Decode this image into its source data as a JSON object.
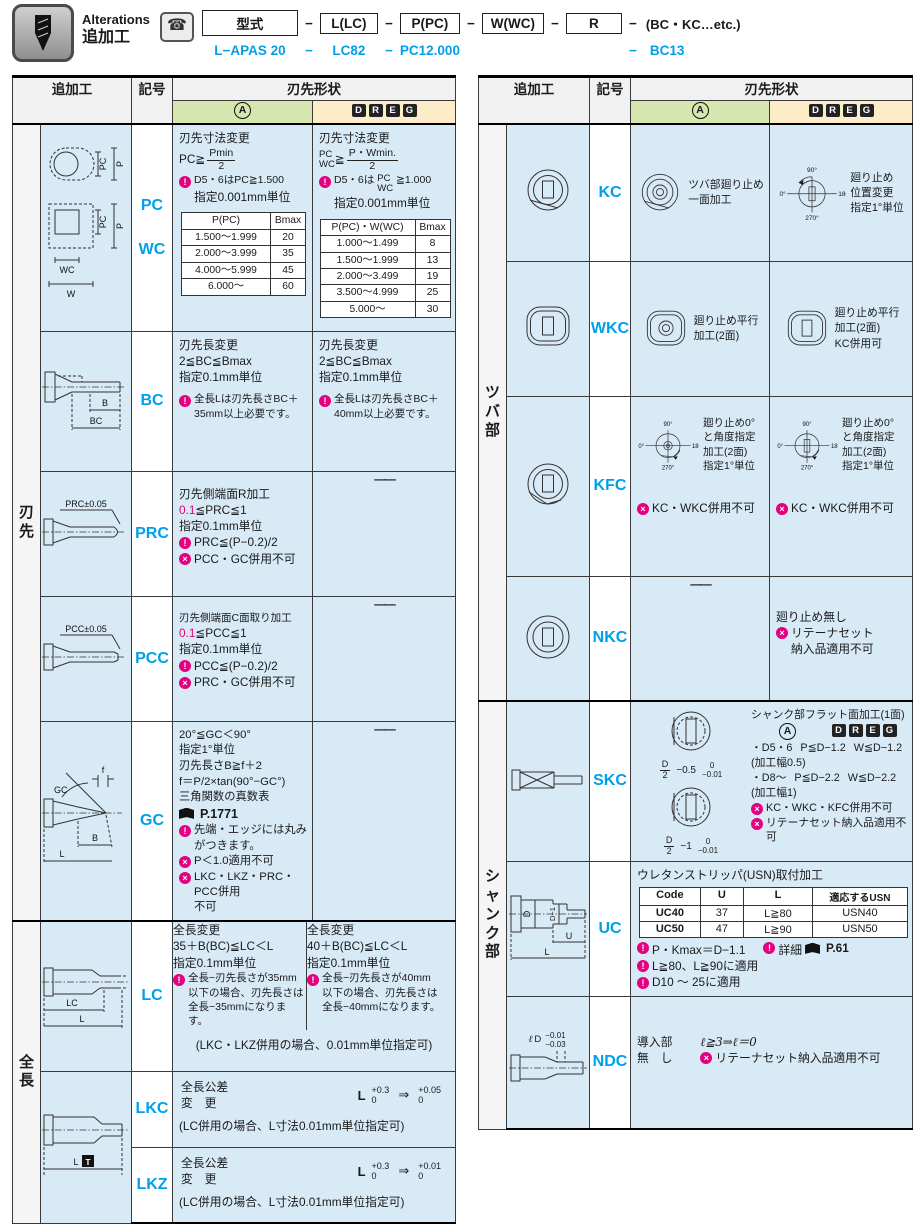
{
  "header": {
    "badge_en": "Alterations",
    "badge_ja": "追加工",
    "phone_icon": "☎",
    "dash": "−",
    "boxes": {
      "model": "型式",
      "l": "L(LC)",
      "p": "P(PC)",
      "w": "W(WC)",
      "r": "R"
    },
    "etc": "(BC・KC…etc.)",
    "ex": {
      "model": "L−APAS 20",
      "lc": "LC82",
      "pc": "PC12.000",
      "bc": "BC13"
    }
  },
  "head": {
    "add": "追加工",
    "sym": "記号",
    "shape": "刃先形状",
    "a": "A",
    "d": "D",
    "r": "R",
    "e": "E",
    "g": "G"
  },
  "common": {
    "dash_cell": "——",
    "angles": {
      "t": "90°",
      "l": "0°",
      "r": "180°",
      "b": "270°"
    }
  },
  "left": {
    "g1": "刃先",
    "g2": "全長",
    "pcwc": {
      "sym1": "PC",
      "sym2": "WC",
      "dg": {
        "pc": "PC",
        "p": "P",
        "wc": "WC",
        "w": "W"
      },
      "a": {
        "t1": "刃先寸法変更",
        "fl": "PC≧",
        "fn": "Pmin",
        "fd": "2",
        "c1": "D5・6はPC≧1.500",
        "t2": "指定0.001mm単位",
        "th1": "P(PC)",
        "th2": "Bmax",
        "r": [
          [
            "1.500～1.999",
            "20"
          ],
          [
            "2.000～3.999",
            "35"
          ],
          [
            "4.000～5.999",
            "45"
          ],
          [
            "6.000～",
            "60"
          ]
        ]
      },
      "d": {
        "t1": "刃先寸法変更",
        "ft": "PC",
        "fb": "WC",
        "fo": "≧",
        "fn": "P・Wmin.",
        "fd": "2",
        "c1a": "D5・6は",
        "c1t": "PC",
        "c1b": "WC",
        "c1c": "≧1.000",
        "t2": "指定0.001mm単位",
        "th1": "P(PC)・W(WC)",
        "th2": "Bmax",
        "r": [
          [
            "1.000～1.499",
            "8"
          ],
          [
            "1.500～1.999",
            "13"
          ],
          [
            "2.000～3.499",
            "19"
          ],
          [
            "3.500～4.999",
            "25"
          ],
          [
            "5.000～",
            "30"
          ]
        ]
      }
    },
    "bc": {
      "sym": "BC",
      "dgB": "B",
      "dgBC": "BC",
      "a": {
        "t1": "刃先長変更",
        "t2": "2≦BC≦Bmax",
        "t3": "指定0.1mm単位",
        "c1": "全長Lは刃先長さBC＋",
        "c2": "35mm以上必要です。"
      },
      "d": {
        "t1": "刃先長変更",
        "t2": "2≦BC≦Bmax",
        "t3": "指定0.1mm単位",
        "c1": "全長Lは刃先長さBC＋",
        "c2": "40mm以上必要です。"
      }
    },
    "prc": {
      "sym": "PRC",
      "dg": "PRC±0.05",
      "a": {
        "t1": "刃先側端面R加工",
        "v1": "0.1",
        "v2": "≦PRC≦1",
        "t2": "指定0.1mm単位",
        "c1": "PRC≦(P−0.2)/2",
        "p1": "PCC・GC併用不可"
      }
    },
    "pcc": {
      "sym": "PCC",
      "dg": "PCC±0.05",
      "a": {
        "t1": "刃先側端面C面取り加工",
        "v1": "0.1",
        "v2": "≦PCC≦1",
        "t2": "指定0.1mm単位",
        "c1": "PCC≦(P−0.2)/2",
        "p1": "PRC・GC併用不可"
      }
    },
    "gc": {
      "sym": "GC",
      "dgGC": "GC",
      "dgf": "f",
      "dgB": "B",
      "dgL": "L",
      "a": {
        "t1": "20°≦GC＜90°",
        "t2": "指定1°単位",
        "t3": "刃先長さB≧f＋2",
        "t4": "f＝P/2×tan(90°−GC°)",
        "t5": "三角関数の真数表",
        "ref": "P.1771",
        "c1": "先端・エッジには丸み",
        "c2": "がつきます。",
        "p1": "P＜1.0適用不可",
        "p2": "LKC・LKZ・PRC・PCC併用",
        "p3": "不可"
      }
    },
    "lc": {
      "sym": "LC",
      "dgLC": "LC",
      "dgL": "L",
      "a": {
        "t1": "全長変更",
        "t2": "35＋B(BC)≦LC＜L",
        "t3": "指定0.1mm単位",
        "c1": "全長−刃先長さが35mm",
        "c2": "以下の場合、刃先長さは",
        "c3": "全長−35mmになります。"
      },
      "d": {
        "t1": "全長変更",
        "t2": "40＋B(BC)≦LC＜L",
        "t3": "指定0.1mm単位",
        "c1": "全長−刃先長さが40mm",
        "c2": "以下の場合、刃先長さは",
        "c3": "全長−40mmになります。"
      },
      "note": "(LKC・LKZ併用の場合、0.01mm単位指定可)"
    },
    "lk": {
      "dgL": "L",
      "dgT": "T"
    },
    "lkc": {
      "sym": "LKC",
      "l1": "全長公差",
      "l2": "変　更",
      "tb": "L",
      "t1": "+0.3",
      "t2": "0",
      "ar": "⇒",
      "t3": "+0.05",
      "t4": "0",
      "note": "(LC併用の場合、L寸法0.01mm単位指定可)"
    },
    "lkz": {
      "sym": "LKZ",
      "l1": "全長公差",
      "l2": "変　更",
      "tb": "L",
      "t1": "+0.3",
      "t2": "0",
      "ar": "⇒",
      "t3": "+0.01",
      "t4": "0",
      "note": "(LC併用の場合、L寸法0.01mm単位指定可)"
    }
  },
  "right": {
    "g1": "ツバ部",
    "g2": "シャンク部",
    "kc": {
      "sym": "KC",
      "a": [
        "ツバ部廻り止め",
        "一面加工"
      ],
      "d": [
        "廻り止め",
        "位置変更",
        "指定1°単位"
      ]
    },
    "wkc": {
      "sym": "WKC",
      "a": [
        "廻り止め平行",
        "加工(2面)"
      ],
      "d": [
        "廻り止め平行",
        "加工(2面)",
        "KC併用可"
      ]
    },
    "kfc": {
      "sym": "KFC",
      "t": [
        "廻り止め0°",
        "と角度指定",
        "加工(2面)",
        "指定1°単位"
      ],
      "p": "KC・WKC併用不可"
    },
    "nkc": {
      "sym": "NKC",
      "d1": "廻り止め無し",
      "p1": "リテーナセット",
      "p2": "納入品適用不可"
    },
    "skc": {
      "sym": "SKC",
      "title": "シャンク部フラット面加工(1面)",
      "l1a": "・D5・6",
      "l1b": "P≦D−1.2",
      "l1c": "W≦D−1.2",
      "l1n": "(加工幅0.5)",
      "l2a": "・D8～",
      "l2b": "P≦D−2.2",
      "l2c": "W≦D−2.2",
      "l2n": "(加工幅1)",
      "p1": "KC・WKC・KFC併用不可",
      "p2": "リテーナセット納入品適用不可",
      "d1n": "D",
      "d1d": "2",
      "d1m": "−0.5",
      "d1t": "0",
      "d1b": "−0.01",
      "d2n": "D",
      "d2d": "2",
      "d2m": "−1",
      "d2t": "0",
      "d2b": "−0.01"
    },
    "uc": {
      "sym": "UC",
      "title": "ウレタンストリッパ(USN)取付加工",
      "th": [
        "Code",
        "U",
        "L",
        "適応するUSN"
      ],
      "rows": [
        [
          "UC40",
          "37",
          "L≧80",
          "USN40"
        ],
        [
          "UC50",
          "47",
          "L≧90",
          "USN50"
        ]
      ],
      "n1": "P・Kmax＝D−1.1",
      "n2": "詳細",
      "n2ref": "P.61",
      "n3": "L≧80、L≧90に適用",
      "n4": "D10 ～ 25に適用",
      "dgD": "D",
      "dgD1": "D−1",
      "dgU": "U",
      "dgL": "L"
    },
    "ndc": {
      "sym": "NDC",
      "t1": "導入部",
      "t2": "無　し",
      "f": "ℓ≧3⇒ℓ＝0",
      "p1": "リテーナセット納入品適用不可",
      "dgl": "ℓ",
      "dgD": "D",
      "dgt": "−0.01",
      "dgb": "−0.03"
    }
  }
}
